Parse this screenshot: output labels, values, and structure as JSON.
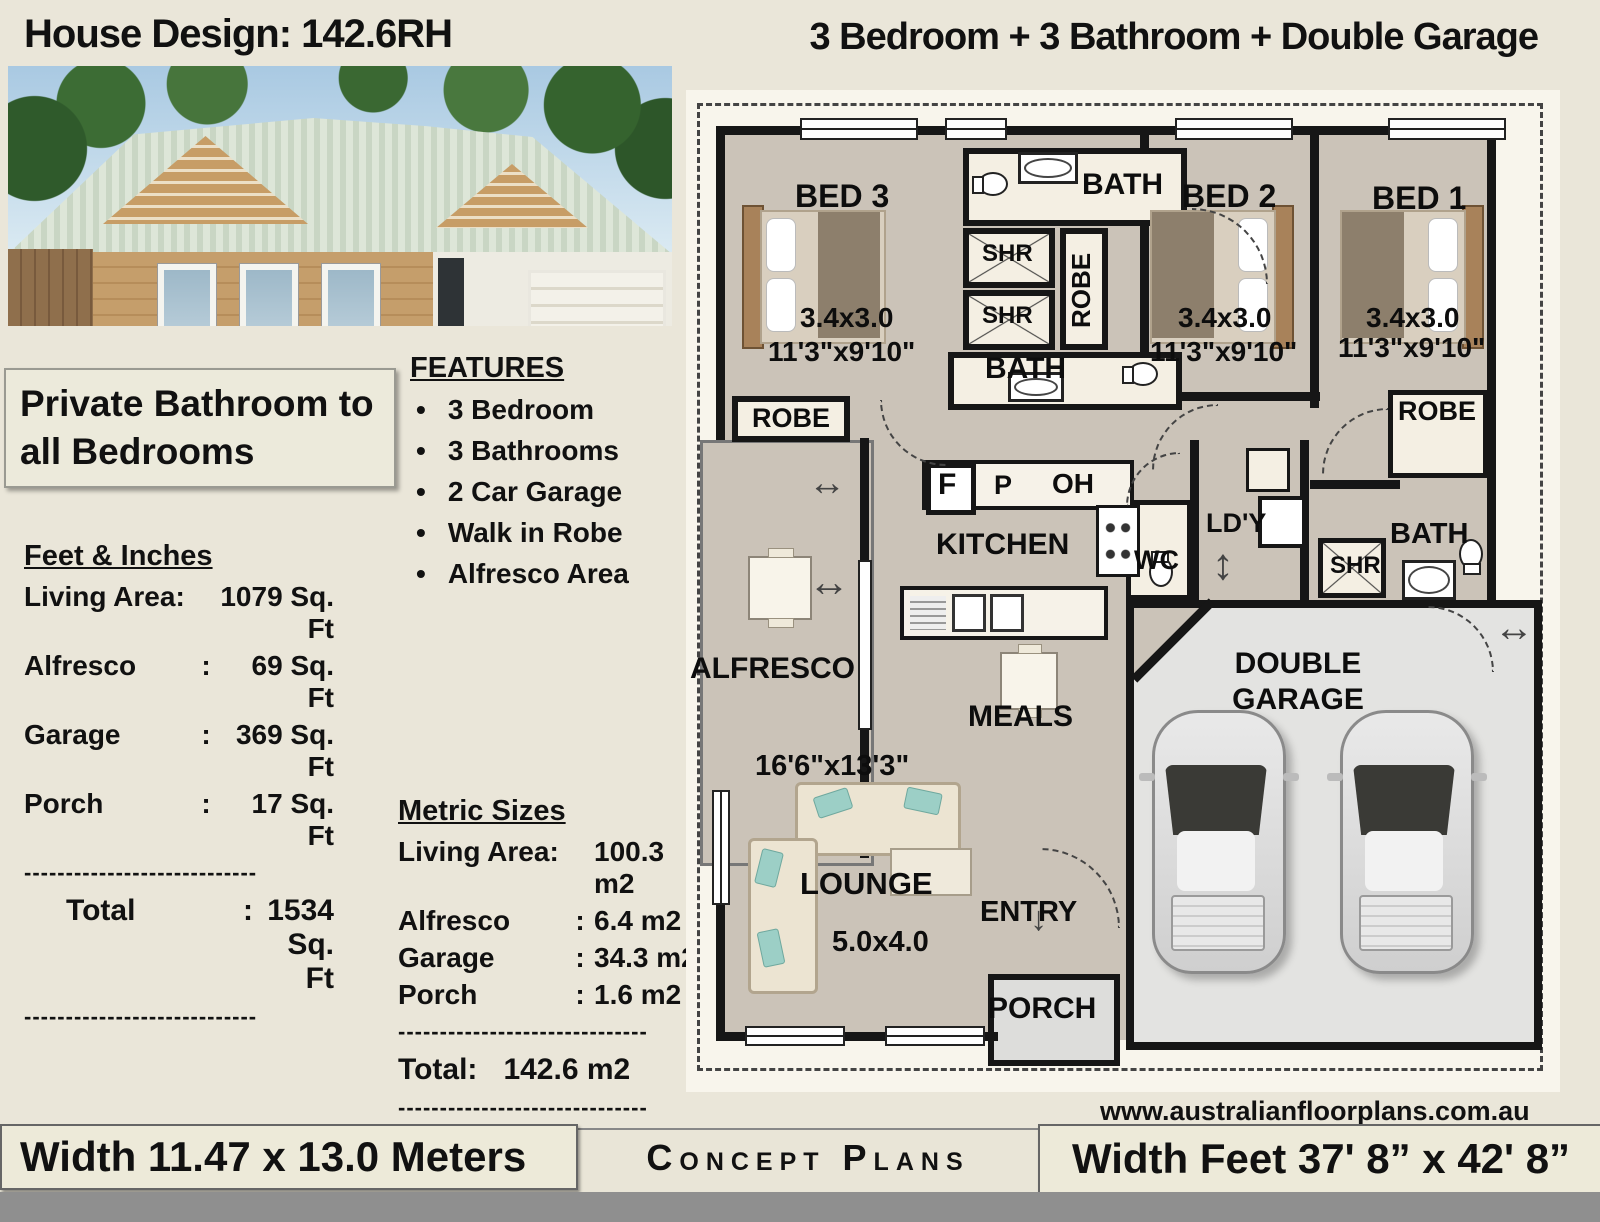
{
  "header": {
    "title": "House Design: 142.6RH",
    "subtitle": "3 Bedroom + 3 Bathroom + Double Garage"
  },
  "highlight": "Private Bathroom to all Bedrooms",
  "features": {
    "title": "FEATURES",
    "items": [
      "3 Bedroom",
      "3 Bathrooms",
      "2 Car Garage",
      "Walk in Robe",
      "Alfresco Area"
    ]
  },
  "feet": {
    "title": "Feet & Inches",
    "rows": [
      {
        "label": "Living Area:",
        "colon": "",
        "value": "1079 Sq. Ft"
      },
      {
        "label": "Alfresco",
        "colon": ":",
        "value": "69 Sq. Ft"
      },
      {
        "label": "Garage",
        "colon": ":",
        "value": "369 Sq. Ft"
      },
      {
        "label": "Porch",
        "colon": ":",
        "value": "17 Sq. Ft"
      }
    ],
    "divider": "----------------------------",
    "total_label": "Total",
    "total_colon": ":",
    "total_value": "1534 Sq. Ft"
  },
  "metric": {
    "title": "Metric Sizes",
    "rows": [
      {
        "label": "Living Area:",
        "colon": "",
        "value": "100.3 m2"
      },
      {
        "label": "Alfresco",
        "colon": ":",
        "value": "6.4 m2"
      },
      {
        "label": "Garage",
        "colon": ":",
        "value": "34.3 m2"
      },
      {
        "label": "Porch",
        "colon": ":",
        "value": "1.6 m2"
      }
    ],
    "divider": "------------------------------",
    "total_label": "Total:",
    "total_value": "142.6 m2"
  },
  "plan": {
    "rooms": {
      "bed3": "BED 3",
      "bed2": "BED 2",
      "bed1": "BED 1",
      "bath": "BATH",
      "shr": "SHR",
      "robe": "ROBE",
      "kitchen": "KITCHEN",
      "wc": "WC",
      "laundry": "LD'Y",
      "alfresco": "ALFRESCO",
      "meals": "MEALS",
      "lounge": "LOUNGE",
      "entry": "ENTRY",
      "porch": "PORCH",
      "garage": "DOUBLE GARAGE",
      "fridge": "F",
      "pantry": "P",
      "oh": "OH"
    },
    "dims": {
      "bed_metric": "3.4x3.0",
      "bed_imperial": "11'3\"x9'10\"",
      "lounge_imperial": "16'6\"x13'3\"",
      "lounge_metric": "5.0x4.0"
    }
  },
  "footer": {
    "left": "Width 11.47 x 13.0 Meters",
    "center": "Concept Plans",
    "right": "Width Feet 37' 8” x 42' 8”",
    "website": "www.australianfloorplans.com.au"
  },
  "colors": {
    "page_bg": "#eae6d9",
    "plan_floor": "#cbc3b8",
    "wall": "#161616",
    "room_white": "#f4efe3",
    "garage_floor": "#e3e3e1"
  }
}
